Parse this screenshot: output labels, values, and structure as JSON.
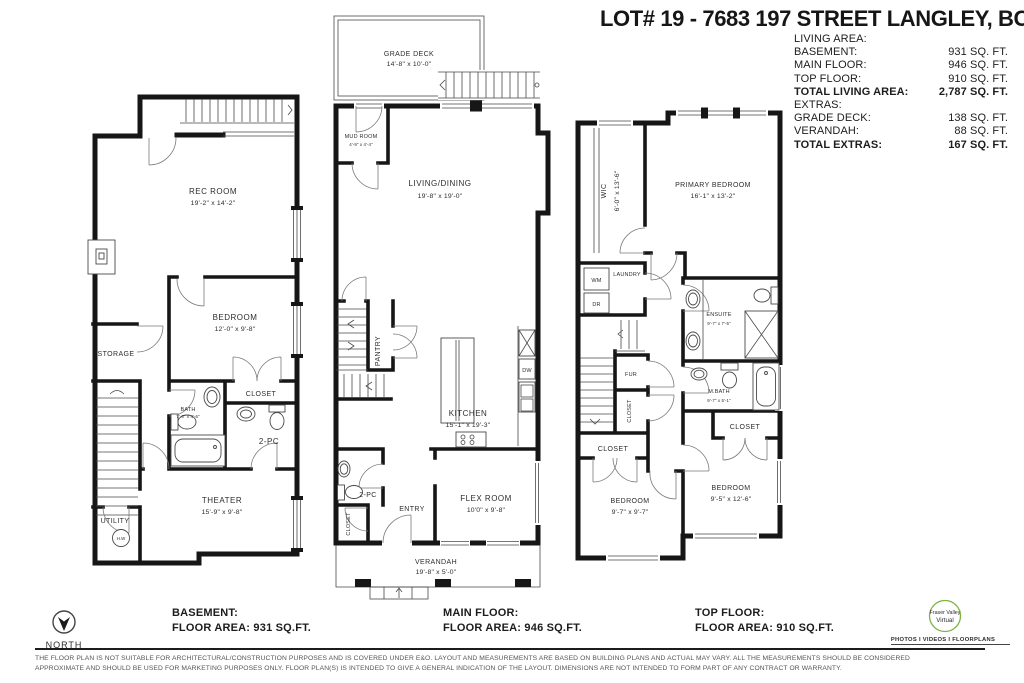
{
  "header": {
    "title": "LOT# 19 - 7683 197 STREET LANGLEY, BC",
    "area_rows": [
      {
        "label": "LIVING AREA:",
        "value": ""
      },
      {
        "label": "BASEMENT:",
        "value": "931 SQ. FT."
      },
      {
        "label": "MAIN FLOOR:",
        "value": "946 SQ. FT."
      },
      {
        "label": "TOP FLOOR:",
        "value": "910 SQ. FT."
      },
      {
        "label": "TOTAL LIVING AREA:",
        "value": "2,787 SQ. FT."
      },
      {
        "label": "EXTRAS:",
        "value": ""
      },
      {
        "label": "GRADE DECK:",
        "value": "138 SQ. FT."
      },
      {
        "label": "VERANDAH:",
        "value": "88 SQ. FT."
      },
      {
        "label": "TOTAL EXTRAS:",
        "value": "167 SQ. FT."
      }
    ]
  },
  "basement": {
    "rec_room_name": "REC ROOM",
    "rec_room_dims": "19'-2\" x 14'-2\"",
    "bedroom_name": "BEDROOM",
    "bedroom_dims": "12'-0\" x 9'-8\"",
    "storage": "STORAGE",
    "closet": "CLOSET",
    "bath_name": "BATH",
    "bath_dims": "7'-6\" x 4'-6\"",
    "two_pc": "2-PC",
    "theater_name": "THEATER",
    "theater_dims": "15'-9\" x 9'-8\"",
    "utility": "UTILITY",
    "hw": "H.W"
  },
  "main_floor": {
    "grade_deck_name": "GRADE DECK",
    "grade_deck_dims": "14'-8\" x 10'-0\"",
    "mud_room_name": "MUD ROOM",
    "mud_room_dims": "4'-9\" x 4'-4\"",
    "living_name": "LIVING/DINING",
    "living_dims": "19'-8\" x 19'-0\"",
    "pantry": "PANTRY",
    "kitchen_name": "KITCHEN",
    "kitchen_dims": "15'-1\" x 19'-3\"",
    "dw": "DW",
    "two_pc": "2-PC",
    "entry": "ENTRY",
    "closet": "CLOSET",
    "flex_name": "FLEX ROOM",
    "flex_dims": "10'0\" x 9'-8\"",
    "verandah_name": "VERANDAH",
    "verandah_dims": "19'-8\" x 5'-0\""
  },
  "top_floor": {
    "wic_name": "WIC",
    "wic_dims": "6'-0\" x 13'-6\"",
    "primary_name": "PRIMARY BEDROOM",
    "primary_dims": "16'-1\" x 13'-2\"",
    "laundry": "LAUNDRY",
    "wm": "WM",
    "dr": "DR",
    "ensuite_name": "ENSUITE",
    "ensuite_dims": "9'-7\" x 7'-5\"",
    "fur": "FUR",
    "closet_mid": "CLOSET",
    "mbath_name": "M.BATH",
    "mbath_dims": "9'-7\" x 5'-1\"",
    "closet_right": "CLOSET",
    "closet_left": "CLOSET",
    "bedroom_left_name": "BEDROOM",
    "bedroom_left_dims": "9'-7\" x 9'-7\"",
    "bedroom_right_name": "BEDROOM",
    "bedroom_right_dims": "9'-5\" x 12'-6\""
  },
  "footer": {
    "north": "NORTH",
    "floors": [
      {
        "name": "BASEMENT:",
        "area": "FLOOR AREA: 931 SQ.FT."
      },
      {
        "name": "MAIN FLOOR:",
        "area": "FLOOR AREA: 946 SQ.FT."
      },
      {
        "name": "TOP FLOOR:",
        "area": "FLOOR AREA: 910 SQ.FT."
      }
    ],
    "logo_line1": "Fraser Valley",
    "logo_line2": "Virtual",
    "logo_tagline": "PHOTOS I VIDEOS I FLOORPLANS",
    "disclaimer_line1": "THE FLOOR PLAN IS NOT SUITABLE FOR ARCHITECTURAL/CONSTRUCTION PURPOSES AND IS COVERED UNDER E&O. LAYOUT AND MEASUREMENTS ARE BASED ON BUILDING PLANS AND ACTUAL MAY VARY. ALL THE MEASUREMENTS SHOULD BE CONSIDERED",
    "disclaimer_line2": "APPROXIMATE AND SHOULD BE USED FOR MARKETING PURPOSES ONLY. FLOOR PLAN(S) IS INTENDED TO GIVE A GENERAL INDICATION OF THE LAYOUT. DIMENSIONS ARE NOT INTENDED TO FORM PART OF ANY CONTRACT OR WARRANTY."
  },
  "colors": {
    "wall": "#161616",
    "logo_green": "#7cb342",
    "logo_blue": "#7da0c4"
  }
}
